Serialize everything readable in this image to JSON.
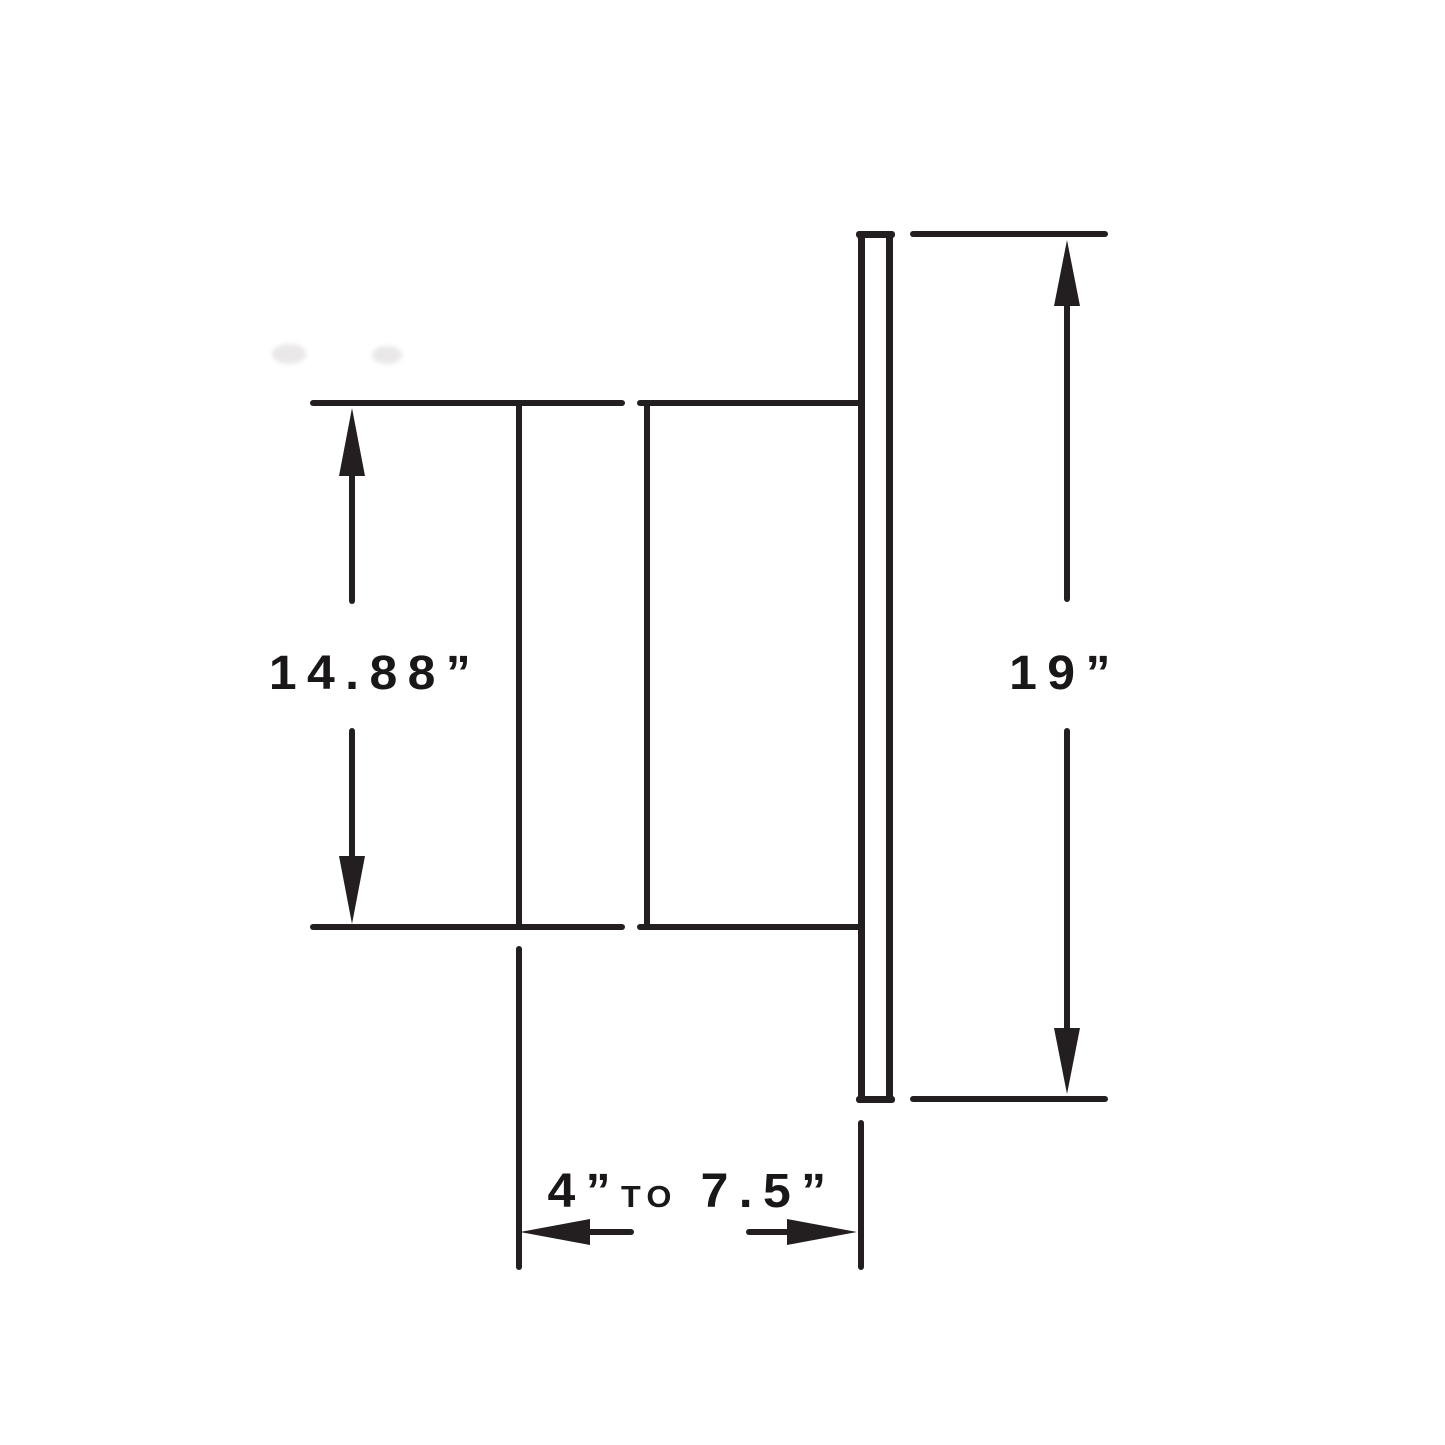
{
  "page": {
    "background": "#ffffff"
  },
  "drawing": {
    "type": "technical-dimension-drawing",
    "line_color": "#231f20",
    "text_color": "#1a1718",
    "dimensions": {
      "inner_height": {
        "label": "14.88”",
        "inches": 14.88
      },
      "overall_height": {
        "label": "19”",
        "inches": 19
      },
      "depth": {
        "min_label": "4”",
        "connector": "TO",
        "max_label": "7.5”",
        "min_inches": 4,
        "max_inches": 7.5
      }
    }
  }
}
